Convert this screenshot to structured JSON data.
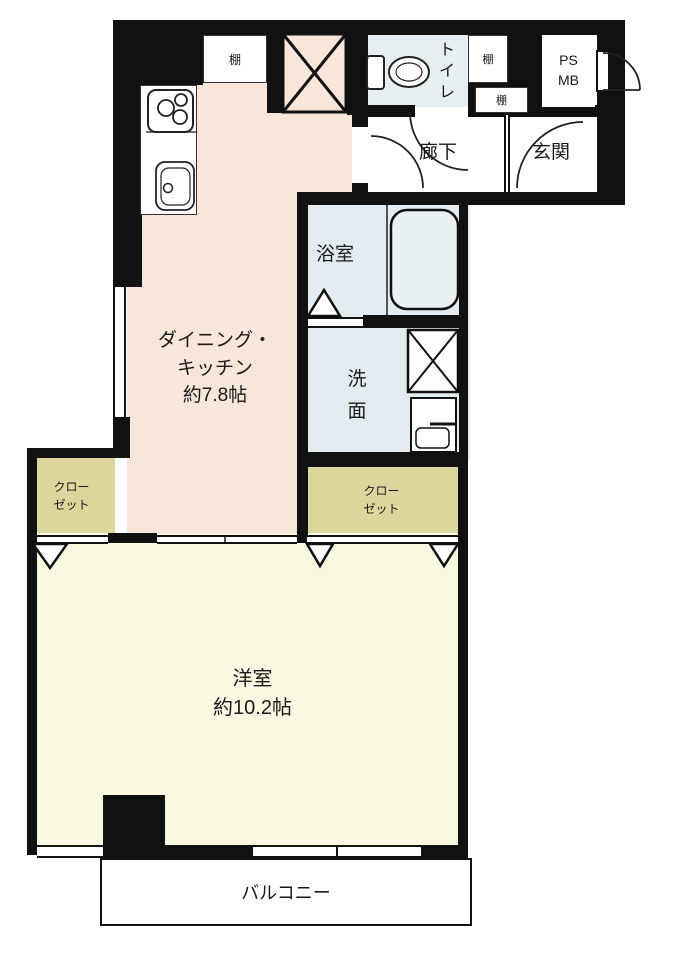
{
  "floorplan": {
    "type": "japanese-apartment-floorplan",
    "rooms": {
      "dining_kitchen": {
        "name_line1": "ダイニング・",
        "name_line2": "キッチン",
        "size": "約7.8帖"
      },
      "western_room": {
        "name": "洋室",
        "size": "約10.2帖"
      },
      "bathroom": {
        "name": "浴室"
      },
      "washroom": {
        "char1": "洗",
        "char2": "面"
      },
      "toilet": {
        "char1": "ト",
        "char2": "イ",
        "char3": "レ"
      },
      "hallway": {
        "name": "廊下"
      },
      "entrance": {
        "name": "玄関"
      },
      "closet_left": {
        "line1": "クロー",
        "line2": "ゼット"
      },
      "closet_right": {
        "line1": "クロー",
        "line2": "ゼット"
      },
      "balcony": {
        "name": "バルコニー"
      },
      "shelf_kitchen": {
        "name": "棚"
      },
      "shelf_toilet_side": {
        "name": "棚"
      },
      "shelf_entrance": {
        "name": "棚"
      },
      "pipe_space": {
        "line1": "PS",
        "line2": "MB"
      }
    },
    "fixtures": {
      "stove": "gas-stove-3-burners",
      "kitchen_sink": "kitchen-sink",
      "refrigerator_space": "x-box-space",
      "bathtub": "bathtub",
      "washer_space": "x-box-washing-machine",
      "vanity": "wash-basin",
      "toilet_bowl": "toilet",
      "doors": "swing-door-arcs-and-fold-triangles",
      "windows": "double-line-windows"
    },
    "colors": {
      "wall": "#111111",
      "dk": "#f9e6da",
      "room": "#fbf8e2",
      "closet": "#dcd69d",
      "wet": "#e1ebf0",
      "toiletRoom": "#e6eef2",
      "tub": "#eaf1f5",
      "text": "#1a1a1a"
    }
  }
}
